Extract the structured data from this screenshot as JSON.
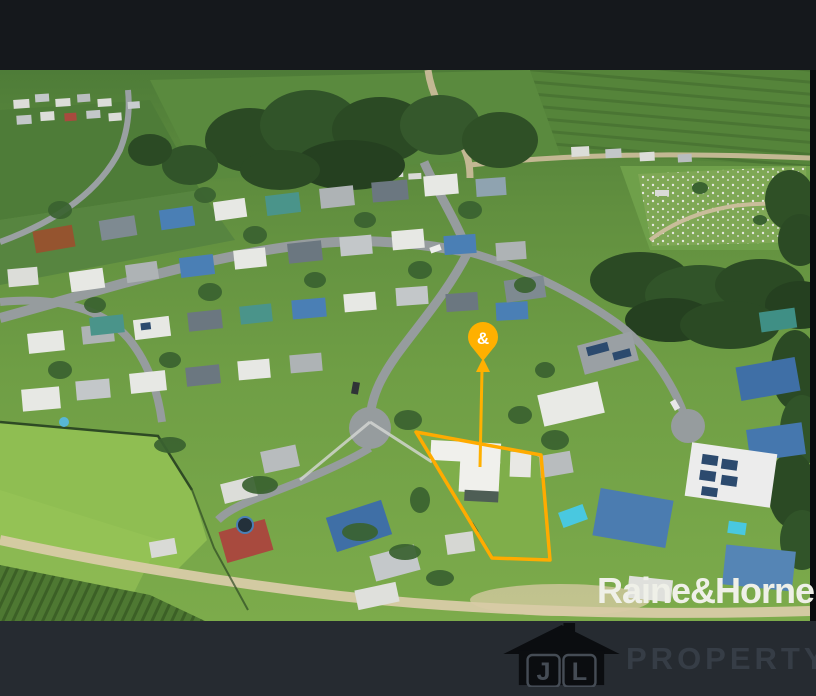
{
  "photo": {
    "description": "aerial drone photo of residential estate, cane fields and highlighted property lot"
  },
  "marker": {
    "label": "&",
    "color": "#ffb000"
  },
  "boundary": {
    "color": "#ffab00",
    "points": "416,362 541,385 550,490 492,488"
  },
  "watermarks": {
    "agency": {
      "name": "Raine&Horne",
      "registered_mark": "®",
      "color": "#eff0e8"
    },
    "agent": {
      "initial_left": "J",
      "initial_right": "L",
      "wordmark": "PROPERTY"
    }
  },
  "frame": {
    "top_bar_color": "#15181c",
    "bottom_bar_color": "#262b31"
  }
}
